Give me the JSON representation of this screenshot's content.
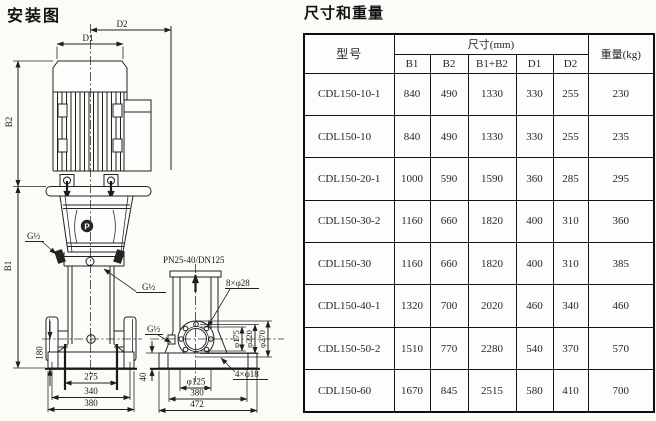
{
  "diagram": {
    "title": "安装图",
    "front_view": {
      "dim_d2": "D2",
      "dim_d1": "D1",
      "dim_b2": "B2",
      "dim_b1": "B1",
      "dim_180": "180",
      "dim_275": "275",
      "dim_340": "340",
      "dim_380": "380",
      "thread_upper": "G½",
      "thread_lower": "G½",
      "logo_mark": "P"
    },
    "side_view": {
      "flange_spec": "PN25-40/DN125",
      "bolt_holes_flange": "8×φ28",
      "dia_175": "φ175",
      "dia_220": "φ220",
      "dia_270": "φ270",
      "dim_40": "40",
      "dia_125": "φ125",
      "dim_380": "380",
      "dim_472": "472",
      "bolt_holes_base": "4×φ18",
      "thread_side": "G½"
    }
  },
  "table": {
    "title": "尺寸和重量",
    "col_model": "型号",
    "col_size_group": "尺寸(mm)",
    "size_cols": [
      "B1",
      "B2",
      "B1+B2",
      "D1",
      "D2"
    ],
    "col_weight": "重量(kg)",
    "rows": [
      [
        "CDL150-10-1",
        "840",
        "490",
        "1330",
        "330",
        "255",
        "230"
      ],
      [
        "CDL150-10",
        "840",
        "490",
        "1330",
        "330",
        "255",
        "235"
      ],
      [
        "CDL150-20-1",
        "1000",
        "590",
        "1590",
        "360",
        "285",
        "295"
      ],
      [
        "CDL150-30-2",
        "1160",
        "660",
        "1820",
        "400",
        "310",
        "360"
      ],
      [
        "CDL150-30",
        "1160",
        "660",
        "1820",
        "400",
        "310",
        "385"
      ],
      [
        "CDL150-40-1",
        "1320",
        "700",
        "2020",
        "460",
        "340",
        "460"
      ],
      [
        "CDL150-50-2",
        "1510",
        "770",
        "2280",
        "540",
        "370",
        "570"
      ],
      [
        "CDL150-60",
        "1670",
        "845",
        "2515",
        "580",
        "410",
        "700"
      ]
    ]
  }
}
